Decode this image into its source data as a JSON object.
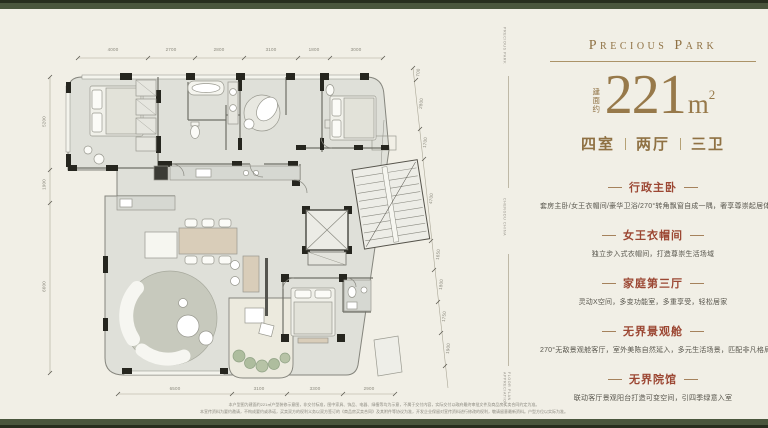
{
  "brand": {
    "logo": "Precious Park"
  },
  "area": {
    "prefix": "建面约",
    "value": "221",
    "unit": "m",
    "sup": "2"
  },
  "layout": {
    "rooms": "四室",
    "halls": "两厅",
    "baths": "三卫"
  },
  "features": [
    {
      "title": "行政主卧",
      "desc": "套房主卧/女王衣帽间/豪华卫浴/270°转角飘窗自成一隅，奢享尊崇起居体验"
    },
    {
      "title": "女王衣帽间",
      "desc": "独立步入式衣帽间，打造尊崇生活场域"
    },
    {
      "title": "家庭第三厅",
      "desc": "灵动X空间，多变功能室，多重享受，轻松居家"
    },
    {
      "title": "无界景观舱",
      "desc": "270°无敌景观舱客厅，室外美陈自然延入，多元生活场景，匹配非凡格局"
    },
    {
      "title": "无界院馆",
      "desc": "联动客厅景观阳台打造可变空间，引四季绿意入室"
    }
  ],
  "watermarks": {
    "top": "PRECIOUS PARK",
    "middle": "CHENGDU CHINA",
    "bottom": "FLOOR PLAN APPRECIATION"
  },
  "dims": {
    "top": [
      "4000",
      "2700",
      "2800",
      "3100",
      "1800",
      "3000"
    ],
    "left": [
      "5200",
      "1900",
      "6600"
    ],
    "right": [
      "700",
      "2800",
      "1700",
      "4700",
      "1650",
      "1800",
      "1750",
      "1900"
    ],
    "bottom": [
      "6500",
      "3100",
      "3300",
      "2900"
    ]
  },
  "disclaimer": {
    "line1": "本户型图为建面约221㎡户型装修示意图，非交付标准，图中家具、饰品、电器、绿植等均为示意，不属于交付内容，实际交付以政府最终审批文件及商品房买卖合同约定为准。",
    "line2": "本宣传资料为要约邀请，不构成要约或承诺，买卖双方的权利义务以双方签订的《商品房买卖合同》及其附件等协议为准，开发企业保留对宣传资料进行修改的权利，敬请留意最新资料。户型方位以实际为准。"
  },
  "colors": {
    "background": "#f1efe6",
    "band_green": "#4a563d",
    "gold": "#8f7143",
    "heading_red": "#9c4733",
    "plan_wall": "#26261f",
    "plan_floor": "#dfe0d9"
  }
}
